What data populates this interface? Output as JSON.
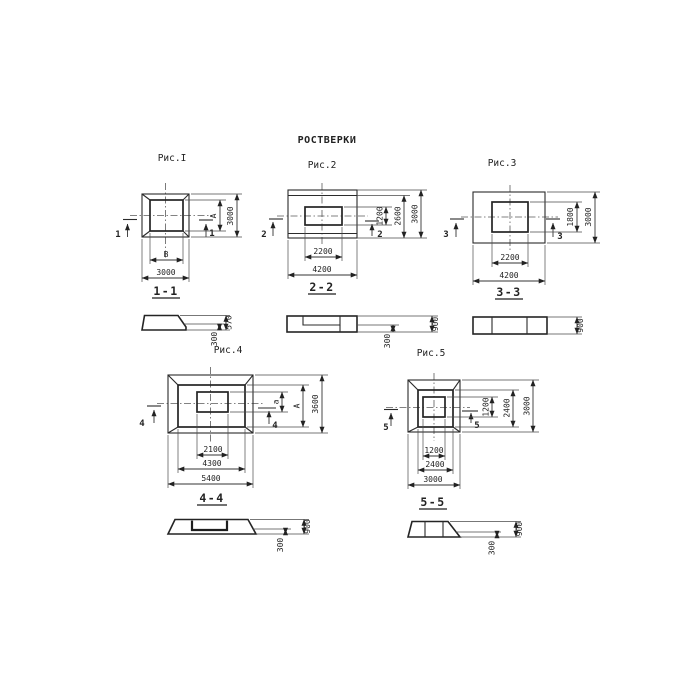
{
  "title": "РОСТВЕРКИ",
  "fig1": {
    "label": "Рис.I",
    "section_mark": "1",
    "dim_inner_width": "В",
    "dim_outer_width": "3000",
    "dim_inner_height": "А",
    "dim_outer_height": "3000",
    "section_label": "1-1",
    "section_dims": {
      "total": "570",
      "step": "300"
    }
  },
  "fig2": {
    "label": "Рис.2",
    "section_mark": "2",
    "dim_inner_width": "2200",
    "dim_outer_width": "4200",
    "dims_right": [
      "1200",
      "2600",
      "3000"
    ],
    "section_label": "2-2",
    "section_dims": {
      "total": "900",
      "step": "300"
    }
  },
  "fig3": {
    "label": "Рис.3",
    "section_mark": "3",
    "dim_inner_width": "2200",
    "dim_outer_width": "4200",
    "dims_right": [
      "1800",
      "3000"
    ],
    "section_label": "3-3",
    "section_dims": {
      "total": "900"
    }
  },
  "fig4": {
    "label": "Рис.4",
    "section_mark": "4",
    "dims_bottom": [
      "2100",
      "4300",
      "5400"
    ],
    "dims_right": [
      "а",
      "А",
      "3600"
    ],
    "section_label": "4-4",
    "section_dims": {
      "total": "900",
      "step": "300"
    }
  },
  "fig5": {
    "label": "Рис.5",
    "section_mark": "5",
    "dims_bottom": [
      "1200",
      "2400",
      "3000"
    ],
    "dims_right": [
      "1200",
      "2400",
      "3000"
    ],
    "section_label": "5-5",
    "section_dims": {
      "total": "900",
      "step": "300"
    }
  }
}
